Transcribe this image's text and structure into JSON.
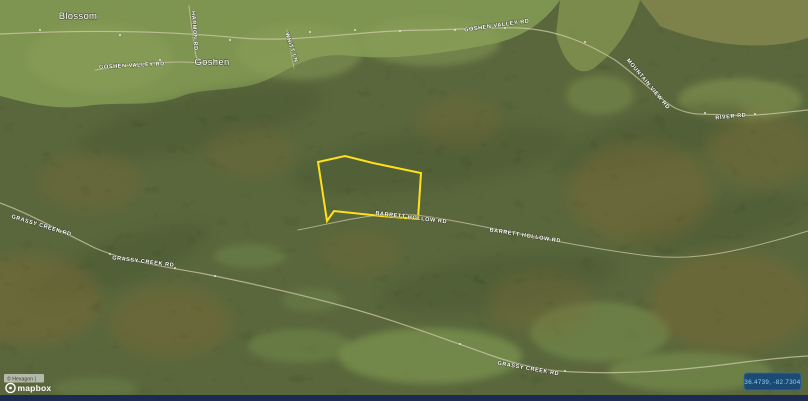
{
  "window": {
    "width": 808,
    "height": 401,
    "type": "satellite-map-view"
  },
  "map": {
    "place_labels": [
      {
        "id": "blossom",
        "text": "Blossom"
      },
      {
        "id": "goshen",
        "text": "Goshen"
      }
    ],
    "road_labels": [
      {
        "id": "goshen-valley-rd-w",
        "text": "GOSHEN VALLEY RD"
      },
      {
        "id": "goshen-valley-rd-e",
        "text": "GOSHEN VALLEY RD"
      },
      {
        "id": "harmon-rd",
        "text": "HARMON RD"
      },
      {
        "id": "whitt-ln",
        "text": "WHITT LN"
      },
      {
        "id": "grassy-creek-rd-1",
        "text": "GRASSY CREEK RD"
      },
      {
        "id": "grassy-creek-rd-2",
        "text": "GRASSY CREEK RD"
      },
      {
        "id": "grassy-creek-rd-3",
        "text": "GRASSY CREEK RD"
      },
      {
        "id": "barrett-hollow-rd-1",
        "text": "BARRETT HOLLOW RD"
      },
      {
        "id": "barrett-hollow-rd-2",
        "text": "BARRETT HOLLOW RD"
      },
      {
        "id": "mountain-view-rd",
        "text": "MOUNTAIN VIEW RD"
      },
      {
        "id": "river-rd",
        "text": "RIVER RD"
      }
    ],
    "parcel_outline_color": "#ffe11a"
  },
  "attribution": {
    "text": "© Hexagon |",
    "logo": "mapbox"
  },
  "status_bar": {
    "coordinates": "36.4739, -82.7304",
    "background": "#1b2b52",
    "badge_background": "#1d4a74",
    "badge_text_color": "#8ed2f2"
  }
}
